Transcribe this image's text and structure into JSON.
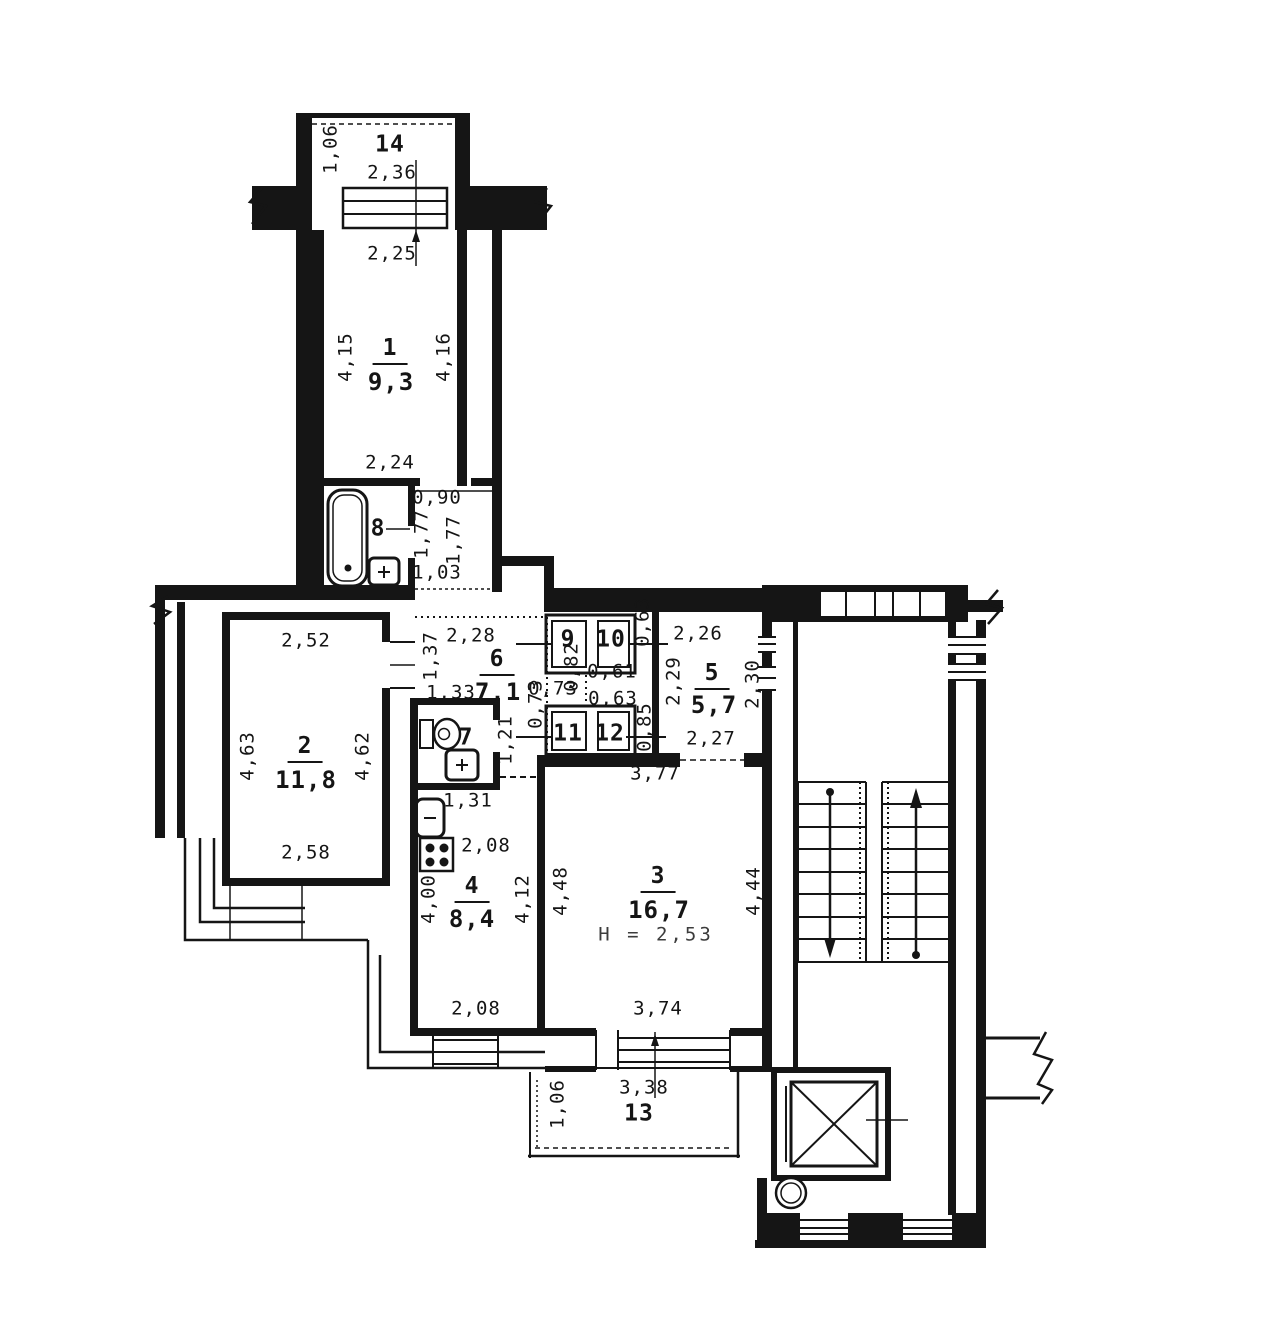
{
  "plan": {
    "drawing_type": "apartment floor plan",
    "rooms": [
      {
        "number": "1",
        "area": "9,3"
      },
      {
        "number": "2",
        "area": "11,8"
      },
      {
        "number": "3",
        "area": "16,7",
        "ceiling_height": "H = 2,53"
      },
      {
        "number": "4",
        "area": "8,4"
      },
      {
        "number": "5",
        "area": "5,7"
      },
      {
        "number": "6",
        "area": "7,1"
      },
      {
        "number": "7"
      },
      {
        "number": "8"
      },
      {
        "number": "9"
      },
      {
        "number": "10"
      },
      {
        "number": "11"
      },
      {
        "number": "12"
      },
      {
        "number": "13"
      },
      {
        "number": "14"
      }
    ],
    "ink_color": "#151515",
    "paper_color": "#ffffff",
    "labels": [
      {
        "t": "1,06",
        "x": 331,
        "y": 149,
        "r": -90,
        "c": "dim"
      },
      {
        "t": "14",
        "x": 390,
        "y": 145,
        "r": 0,
        "c": "room-id"
      },
      {
        "t": "2,36",
        "x": 392,
        "y": 173,
        "r": 0,
        "c": "dim"
      },
      {
        "t": "2,25",
        "x": 392,
        "y": 254,
        "r": 0,
        "c": "dim"
      },
      {
        "t": "4,15",
        "x": 346,
        "y": 357,
        "r": -90,
        "c": "dim"
      },
      {
        "t": "1",
        "x": 390,
        "y": 351,
        "r": 0,
        "c": "num"
      },
      {
        "t": "9,3",
        "x": 391,
        "y": 382,
        "r": 0,
        "c": "area"
      },
      {
        "t": "4,16",
        "x": 444,
        "y": 357,
        "r": -90,
        "c": "dim"
      },
      {
        "t": "2,24",
        "x": 390,
        "y": 463,
        "r": 0,
        "c": "dim"
      },
      {
        "t": "0,90",
        "x": 437,
        "y": 498,
        "r": 0,
        "c": "dim"
      },
      {
        "t": "1,77",
        "x": 422,
        "y": 534,
        "r": -90,
        "c": "dim"
      },
      {
        "t": "1,77",
        "x": 454,
        "y": 540,
        "r": -90,
        "c": "dim"
      },
      {
        "t": "1,03",
        "x": 437,
        "y": 573,
        "r": 0,
        "c": "dim"
      },
      {
        "t": "8",
        "x": 378,
        "y": 529,
        "r": 0,
        "c": "room-id"
      },
      {
        "t": "2,52",
        "x": 306,
        "y": 641,
        "r": 0,
        "c": "dim"
      },
      {
        "t": "4,63",
        "x": 248,
        "y": 756,
        "r": -90,
        "c": "dim"
      },
      {
        "t": "2",
        "x": 305,
        "y": 749,
        "r": 0,
        "c": "num"
      },
      {
        "t": "11,8",
        "x": 306,
        "y": 780,
        "r": 0,
        "c": "area"
      },
      {
        "t": "4,62",
        "x": 363,
        "y": 756,
        "r": -90,
        "c": "dim"
      },
      {
        "t": "2,58",
        "x": 306,
        "y": 853,
        "r": 0,
        "c": "dim"
      },
      {
        "t": "1,37",
        "x": 431,
        "y": 656,
        "r": -90,
        "c": "dim"
      },
      {
        "t": "2,28",
        "x": 471,
        "y": 636,
        "r": 0,
        "c": "dim"
      },
      {
        "t": "6",
        "x": 497,
        "y": 662,
        "r": 0,
        "c": "num"
      },
      {
        "t": "7,1",
        "x": 498,
        "y": 692,
        "r": 0,
        "c": "area"
      },
      {
        "t": "1,33",
        "x": 451,
        "y": 693,
        "r": 0,
        "c": "dim"
      },
      {
        "t": "9",
        "x": 568,
        "y": 640,
        "r": 0,
        "c": "room-id"
      },
      {
        "t": "10",
        "x": 611,
        "y": 640,
        "r": 0,
        "c": "room-id"
      },
      {
        "t": "0,63",
        "x": 643,
        "y": 622,
        "r": -90,
        "c": "dim"
      },
      {
        "t": "0,82",
        "x": 572,
        "y": 667,
        "r": -90,
        "c": "dim"
      },
      {
        "t": "0,61",
        "x": 612,
        "y": 672,
        "r": 0,
        "c": "dim"
      },
      {
        "t": "0,73",
        "x": 553,
        "y": 689,
        "r": 0,
        "c": "dim"
      },
      {
        "t": "0,63",
        "x": 613,
        "y": 699,
        "r": 0,
        "c": "dim"
      },
      {
        "t": "0,73",
        "x": 536,
        "y": 704,
        "r": -90,
        "c": "dim"
      },
      {
        "t": "0,85",
        "x": 645,
        "y": 727,
        "r": -90,
        "c": "dim"
      },
      {
        "t": "11",
        "x": 568,
        "y": 734,
        "r": 0,
        "c": "room-id"
      },
      {
        "t": "12",
        "x": 610,
        "y": 734,
        "r": 0,
        "c": "room-id"
      },
      {
        "t": "2,26",
        "x": 698,
        "y": 634,
        "r": 0,
        "c": "dim"
      },
      {
        "t": "2,29",
        "x": 674,
        "y": 681,
        "r": -90,
        "c": "dim"
      },
      {
        "t": "5",
        "x": 712,
        "y": 676,
        "r": 0,
        "c": "num"
      },
      {
        "t": "5,7",
        "x": 714,
        "y": 705,
        "r": 0,
        "c": "area"
      },
      {
        "t": "2,30",
        "x": 753,
        "y": 684,
        "r": -90,
        "c": "dim"
      },
      {
        "t": "2,27",
        "x": 711,
        "y": 739,
        "r": 0,
        "c": "dim"
      },
      {
        "t": "7",
        "x": 466,
        "y": 738,
        "r": 0,
        "c": "room-id"
      },
      {
        "t": "1,21",
        "x": 506,
        "y": 740,
        "r": -90,
        "c": "dim"
      },
      {
        "t": "1,31",
        "x": 468,
        "y": 801,
        "r": 0,
        "c": "dim"
      },
      {
        "t": "2,08",
        "x": 486,
        "y": 846,
        "r": 0,
        "c": "dim"
      },
      {
        "t": "4,00",
        "x": 429,
        "y": 899,
        "r": -90,
        "c": "dim"
      },
      {
        "t": "4",
        "x": 472,
        "y": 889,
        "r": 0,
        "c": "num"
      },
      {
        "t": "8,4",
        "x": 472,
        "y": 919,
        "r": 0,
        "c": "area"
      },
      {
        "t": "4,12",
        "x": 523,
        "y": 899,
        "r": -90,
        "c": "dim"
      },
      {
        "t": "2,08",
        "x": 476,
        "y": 1009,
        "r": 0,
        "c": "dim"
      },
      {
        "t": "3,77",
        "x": 655,
        "y": 774,
        "r": 0,
        "c": "dim"
      },
      {
        "t": "4,48",
        "x": 561,
        "y": 891,
        "r": -90,
        "c": "dim"
      },
      {
        "t": "3",
        "x": 658,
        "y": 879,
        "r": 0,
        "c": "num"
      },
      {
        "t": "16,7",
        "x": 659,
        "y": 910,
        "r": 0,
        "c": "area"
      },
      {
        "t": "H = 2,53",
        "x": 656,
        "y": 935,
        "r": 0,
        "c": "note"
      },
      {
        "t": "4,44",
        "x": 754,
        "y": 891,
        "r": -90,
        "c": "dim"
      },
      {
        "t": "3,74",
        "x": 658,
        "y": 1009,
        "r": 0,
        "c": "dim"
      },
      {
        "t": "1,06",
        "x": 558,
        "y": 1104,
        "r": -90,
        "c": "dim"
      },
      {
        "t": "3,38",
        "x": 644,
        "y": 1088,
        "r": 0,
        "c": "dim"
      },
      {
        "t": "13",
        "x": 639,
        "y": 1114,
        "r": 0,
        "c": "room-id"
      }
    ]
  }
}
